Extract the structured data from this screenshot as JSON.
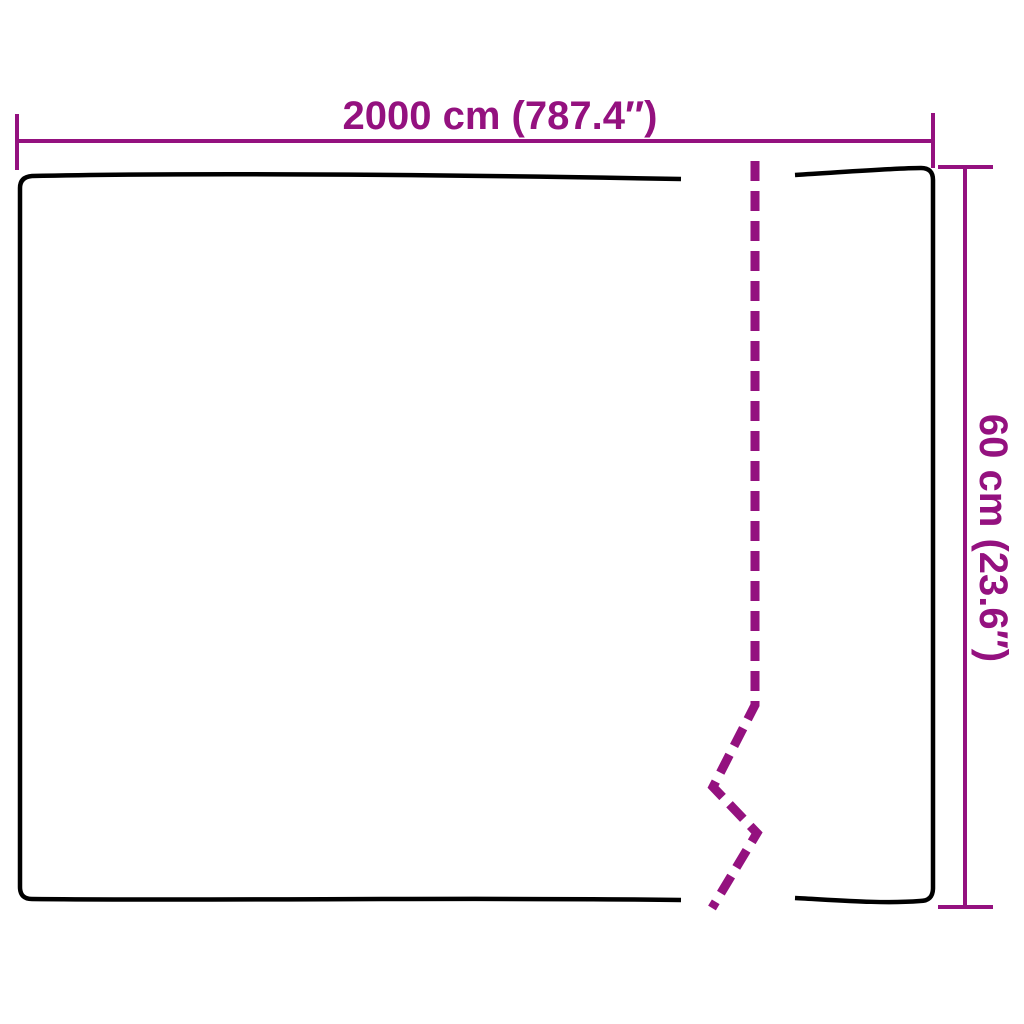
{
  "diagram": {
    "type": "product-dimension-diagram",
    "width_label": "2000 cm (787.4″)",
    "height_label": "60 cm (23.6″)",
    "colors": {
      "background": "#ffffff",
      "outline": "#000000",
      "dimension": "#94117f"
    }
  }
}
